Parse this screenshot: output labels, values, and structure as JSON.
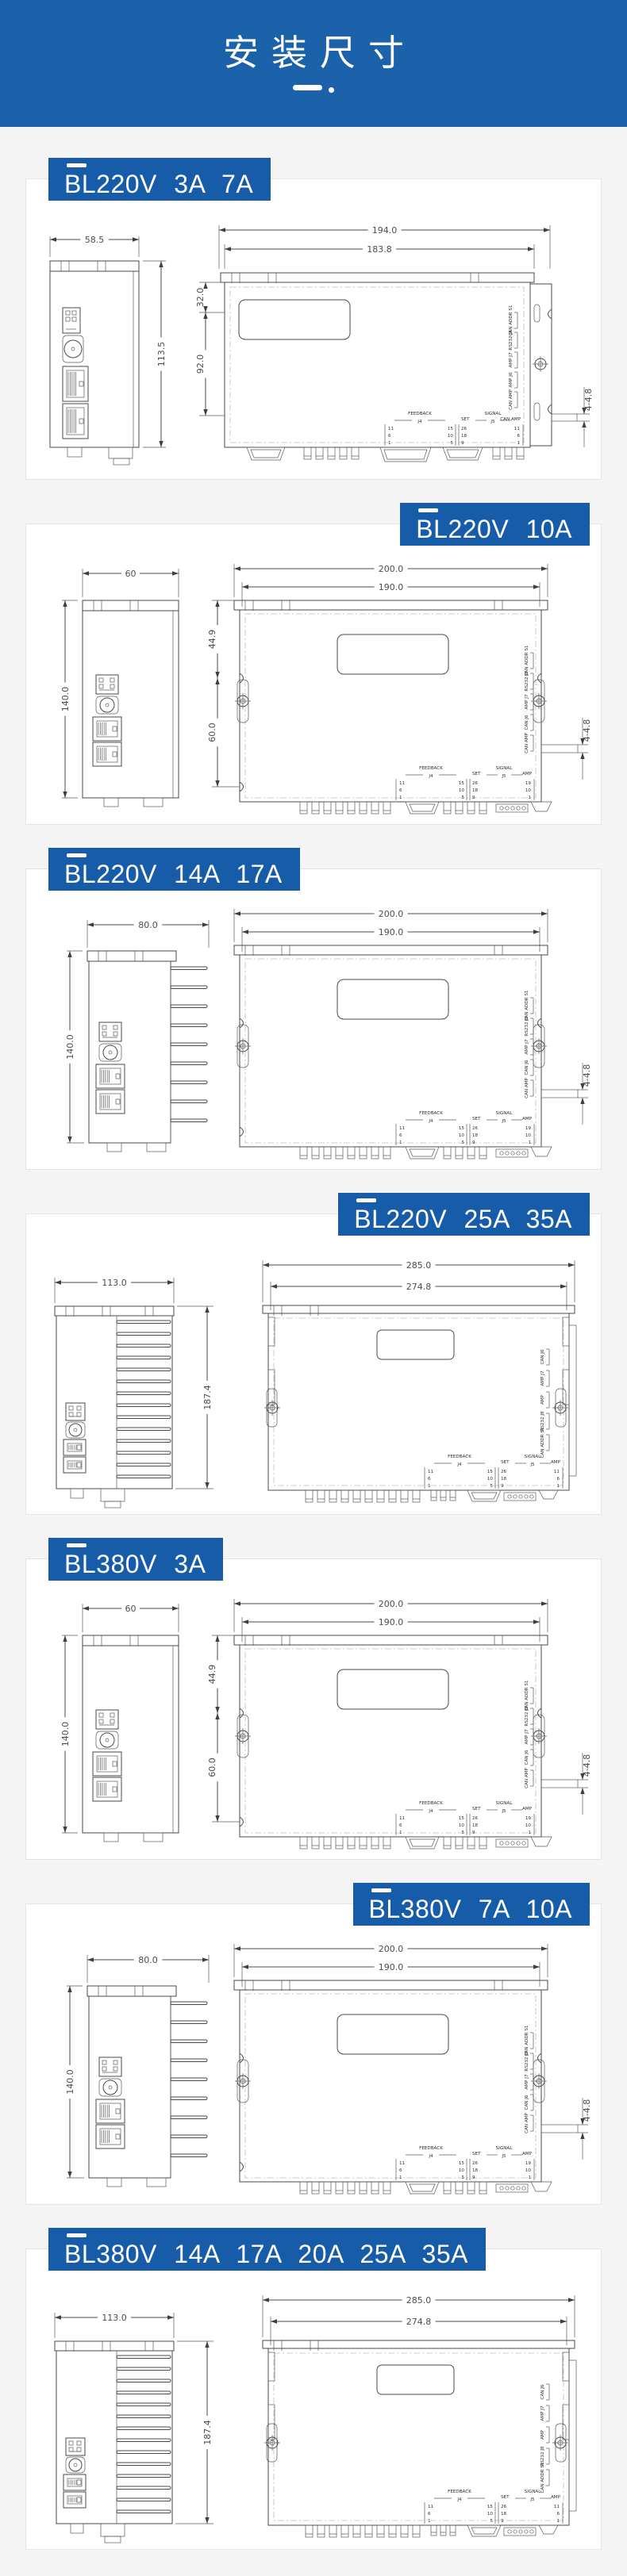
{
  "theme": {
    "header_bg": "#1b62ab",
    "tag_bg": "#175ca9",
    "page_bg": "#f4f4f4",
    "card_bg": "#ffffff",
    "line_color": "#4a4a4a"
  },
  "header": {
    "title": "安装尺寸"
  },
  "sections": [
    {
      "id": "bl220v-3a-7a",
      "label": "BL220V 3A 7A",
      "label_side": "left",
      "drawing_type": "A",
      "side_view": {
        "width_dim": "58.5",
        "height_dim": "113.5"
      },
      "front_view": {
        "dim_outer": "194.0",
        "dim_inner": "183.8",
        "dims_left": [
          "32.0",
          "92.0"
        ],
        "dim_right": "4-4.8"
      },
      "right_stack": [
        "CAN ADDR S1",
        "RS232 J8",
        "AMP J7",
        "AMP J6",
        "CAN AMP"
      ],
      "table": {
        "feedback": "FEEDBACK",
        "j4": "J4",
        "col1": [
          "11",
          "6",
          "1"
        ],
        "col2": [
          "15",
          "10",
          "5"
        ],
        "set": "SET",
        "set_col": [
          "26",
          "18",
          "9"
        ],
        "signal": "SIGNAL",
        "j5": "J5",
        "amp": "CAN AMP",
        "col3": [
          "11",
          "6",
          "1"
        ]
      }
    },
    {
      "id": "bl220v-10a",
      "label": "BL220V 10A",
      "label_side": "right",
      "drawing_type": "B",
      "side_view": {
        "width_dim": "60",
        "height_dim": "140.0"
      },
      "front_view": {
        "dim_outer": "200.0",
        "dim_inner": "190.0",
        "dims_left": [
          "44.9",
          "60.0"
        ],
        "dim_right": "4-4.8"
      },
      "right_stack": [
        "CAN ADDR S1",
        "RS232 J8",
        "AMP J7",
        "CAN J6",
        "CAN AMP"
      ],
      "table": {
        "feedback": "FEEDBACK",
        "j4": "J4",
        "col1": [
          "11",
          "6",
          "1"
        ],
        "col2": [
          "15",
          "10",
          "5"
        ],
        "set": "SET",
        "set_col": [
          "26",
          "18",
          "9"
        ],
        "signal": "SIGNAL",
        "j5": "J5",
        "amp": "AMP",
        "col3": [
          "19",
          "10",
          "1"
        ]
      }
    },
    {
      "id": "bl220v-14a-17a",
      "label": "BL220V 14A  17A",
      "label_side": "left",
      "drawing_type": "C",
      "side_view": {
        "width_dim": "80.0",
        "height_dim": "140.0"
      },
      "front_view": {
        "dim_outer": "200.0",
        "dim_inner": "190.0",
        "dims_left": [],
        "dim_right": "4-4.8"
      },
      "right_stack": [
        "CAN ADDR S1",
        "RS232 J8",
        "AMP J7",
        "CAN J6",
        "CAN AMP"
      ],
      "table": {
        "feedback": "FEEDBACK",
        "j4": "J4",
        "col1": [
          "11",
          "6",
          "1"
        ],
        "col2": [
          "15",
          "10",
          "5"
        ],
        "set": "SET",
        "set_col": [
          "26",
          "18",
          "9"
        ],
        "signal": "SIGNAL",
        "j5": "J5",
        "amp": "AMP",
        "col3": [
          "19",
          "10",
          "1"
        ]
      }
    },
    {
      "id": "bl220v-25a-35a",
      "label": "BL220V 25A  35A",
      "label_side": "right",
      "drawing_type": "D",
      "side_view": {
        "width_dim": "113.0",
        "height_dim": "187.4"
      },
      "front_view": {
        "dim_outer": "285.0",
        "dim_inner": "274.8",
        "dims_left": [],
        "dim_right": ""
      },
      "right_stack": [
        "CAN J6",
        "AMP J7",
        "AMP",
        "RS232 J8",
        "CAN ADDR S1"
      ],
      "table": {
        "feedback": "FEEDBACK",
        "j4": "J4",
        "col1": [
          "11",
          "6",
          "1"
        ],
        "col2": [
          "15",
          "10",
          "5"
        ],
        "set": "SET",
        "set_col": [
          "26",
          "18",
          "9"
        ],
        "signal": "SIGNAL",
        "j5": "J5",
        "amp": "AMP",
        "col3": [
          "11",
          "6",
          "1"
        ]
      }
    },
    {
      "id": "bl380v-3a",
      "label": "BL380V 3A",
      "label_side": "left",
      "drawing_type": "B",
      "side_view": {
        "width_dim": "60",
        "height_dim": "140.0"
      },
      "front_view": {
        "dim_outer": "200.0",
        "dim_inner": "190.0",
        "dims_left": [
          "44.9",
          "60.0"
        ],
        "dim_right": "4-4.8"
      },
      "right_stack": [
        "CAN ADDR S1",
        "RS232 J8",
        "AMP J7",
        "CAN J6",
        "CAN AMP"
      ],
      "table": {
        "feedback": "FEEDBACK",
        "j4": "J4",
        "col1": [
          "11",
          "6",
          "1"
        ],
        "col2": [
          "15",
          "10",
          "5"
        ],
        "set": "SET",
        "set_col": [
          "26",
          "18",
          "9"
        ],
        "signal": "SIGNAL",
        "j5": "J5",
        "amp": "AMP",
        "col3": [
          "19",
          "10",
          "1"
        ]
      }
    },
    {
      "id": "bl380v-7a-10a",
      "label": "BL380V 7A 10A",
      "label_side": "right",
      "drawing_type": "C",
      "side_view": {
        "width_dim": "80.0",
        "height_dim": "140.0"
      },
      "front_view": {
        "dim_outer": "200.0",
        "dim_inner": "190.0",
        "dims_left": [],
        "dim_right": "4-4.8"
      },
      "right_stack": [
        "CAN ADDR S1",
        "RS232 J8",
        "AMP J7",
        "CAN J6",
        "CAN AMP"
      ],
      "table": {
        "feedback": "FEEDBACK",
        "j4": "J4",
        "col1": [
          "11",
          "6",
          "1"
        ],
        "col2": [
          "15",
          "10",
          "5"
        ],
        "set": "SET",
        "set_col": [
          "26",
          "18",
          "9"
        ],
        "signal": "SIGNAL",
        "j5": "J5",
        "amp": "AMP",
        "col3": [
          "19",
          "10",
          "1"
        ]
      }
    },
    {
      "id": "bl380v-14a-35a",
      "label": "BL380V 14A  17A   20A   25A   35A",
      "label_side": "left",
      "drawing_type": "D",
      "side_view": {
        "width_dim": "113.0",
        "height_dim": "187.4"
      },
      "front_view": {
        "dim_outer": "285.0",
        "dim_inner": "274.8",
        "dims_left": [],
        "dim_right": ""
      },
      "right_stack": [
        "CAN J6",
        "AMP J7",
        "AMP",
        "RS232 J8",
        "CAN ADDR S1"
      ],
      "table": {
        "feedback": "FEEDBACK",
        "j4": "J4",
        "col1": [
          "11",
          "6",
          "1"
        ],
        "col2": [
          "15",
          "10",
          "5"
        ],
        "set": "SET",
        "set_col": [
          "26",
          "18",
          "9"
        ],
        "signal": "SIGNAL",
        "j5": "J5",
        "amp": "AMP",
        "col3": [
          "11",
          "6",
          "1"
        ]
      }
    }
  ]
}
